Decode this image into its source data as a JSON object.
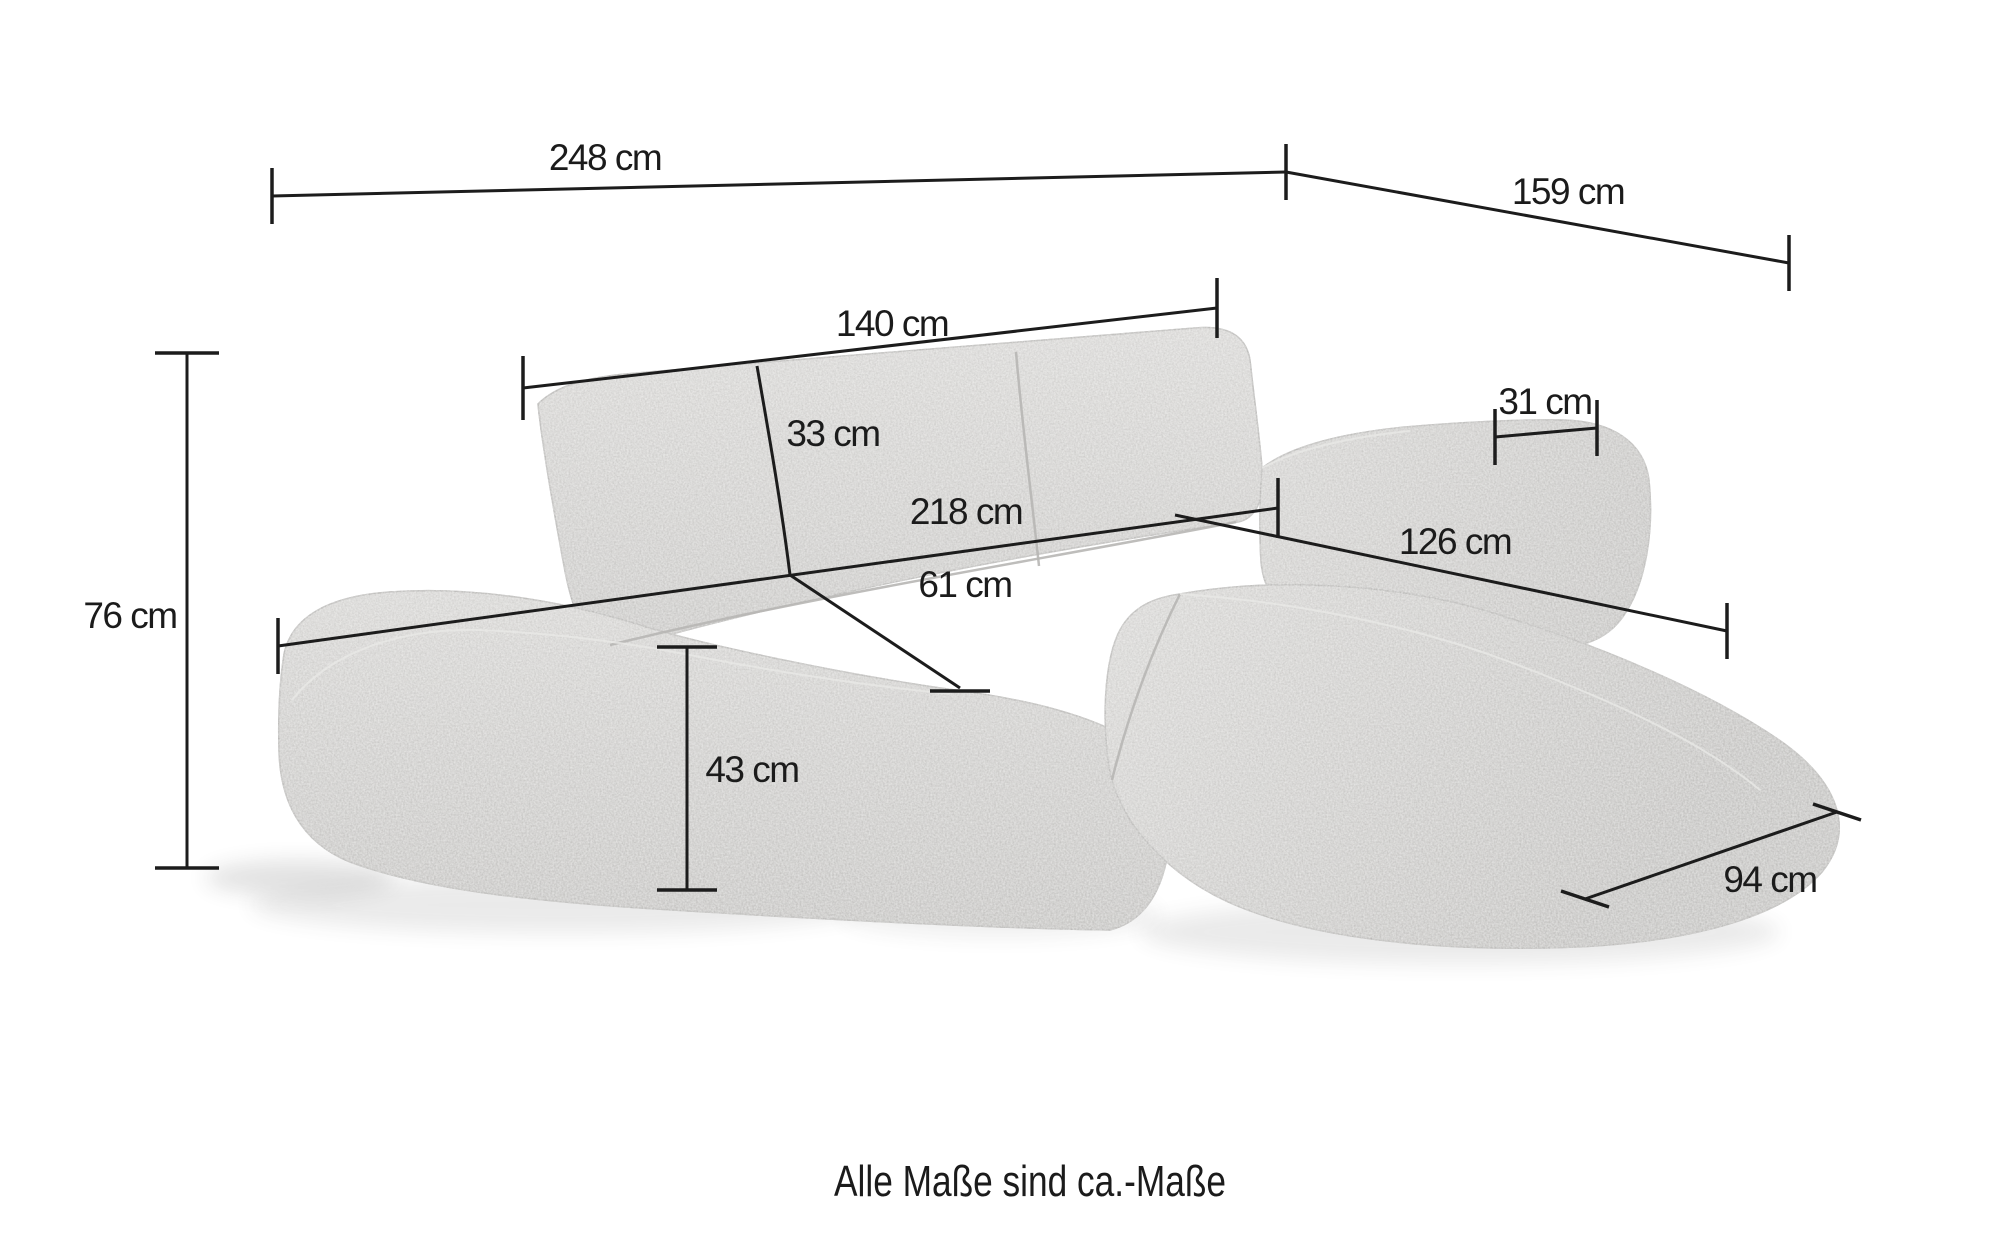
{
  "dimensions": {
    "overall_width": "248 cm",
    "overall_depth": "159 cm",
    "backrest_width": "140 cm",
    "backrest_height": "33 cm",
    "seat_width": "218 cm",
    "seat_depth": "61 cm",
    "armrest_width": "31 cm",
    "total_height": "76 cm",
    "seat_height": "43 cm",
    "chaise_length": "126 cm",
    "chaise_front_width": "94 cm"
  },
  "caption": "Alle Maße sind ca.-Maße",
  "colors": {
    "background": "#ffffff",
    "line": "#1c1c1c",
    "fabric": "#d2d1cf"
  }
}
